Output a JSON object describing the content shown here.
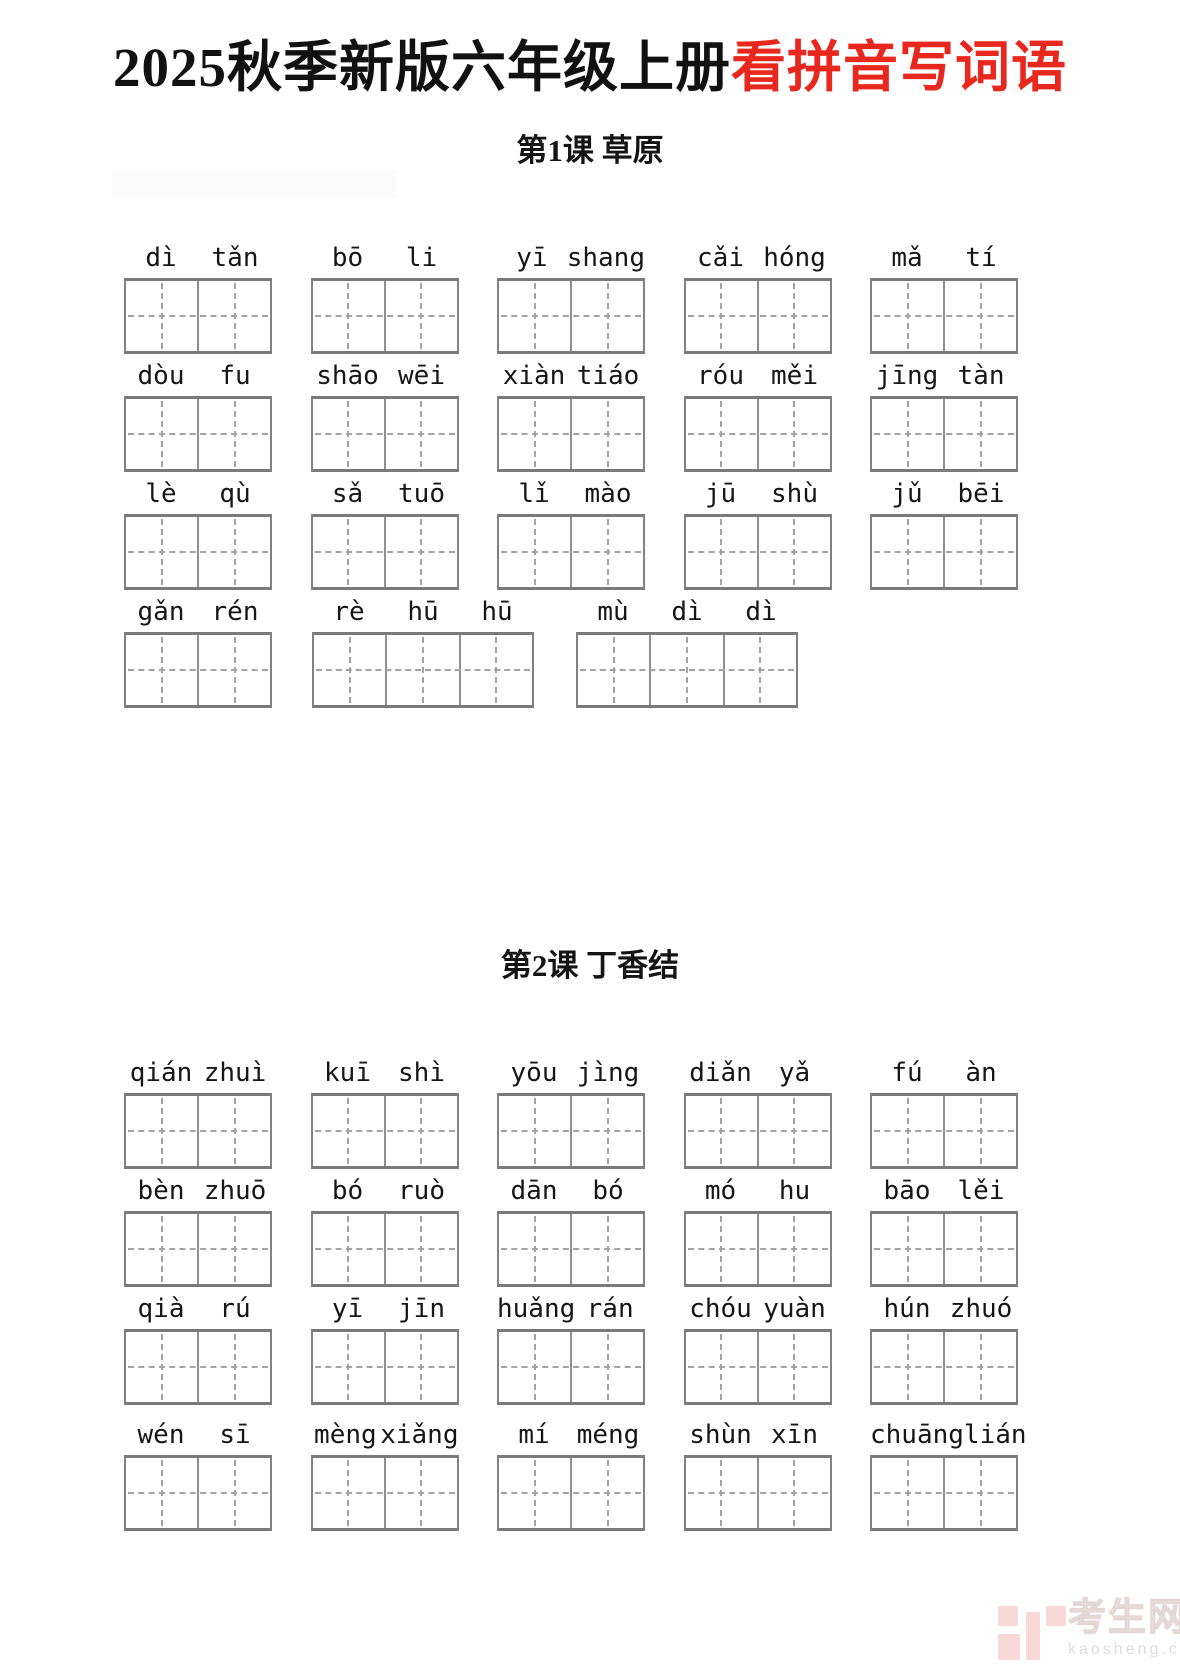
{
  "title": {
    "black_text": "2025秋季新版六年级上册",
    "red_text": "看拼音写词语",
    "black_color": "#111111",
    "red_color": "#e8281e"
  },
  "sections": [
    {
      "heading": "第1课 草原",
      "rows": [
        {
          "words": [
            {
              "syllables": [
                "dì",
                "tǎn"
              ]
            },
            {
              "syllables": [
                "bō",
                "li"
              ]
            },
            {
              "syllables": [
                "yī",
                "shang"
              ]
            },
            {
              "syllables": [
                "cǎi",
                "hóng"
              ]
            },
            {
              "syllables": [
                "mǎ",
                "tí"
              ]
            }
          ]
        },
        {
          "words": [
            {
              "syllables": [
                "dòu",
                "fu"
              ]
            },
            {
              "syllables": [
                "shāo",
                "wēi"
              ]
            },
            {
              "syllables": [
                "xiàn",
                "tiáo"
              ]
            },
            {
              "syllables": [
                "róu",
                "měi"
              ]
            },
            {
              "syllables": [
                "jīng",
                "tàn"
              ]
            }
          ]
        },
        {
          "words": [
            {
              "syllables": [
                "lè",
                "qù"
              ]
            },
            {
              "syllables": [
                "sǎ",
                "tuō"
              ]
            },
            {
              "syllables": [
                "lǐ",
                "mào"
              ]
            },
            {
              "syllables": [
                "jū",
                "shù"
              ]
            },
            {
              "syllables": [
                "jǔ",
                "bēi"
              ]
            }
          ]
        },
        {
          "words": [
            {
              "syllables": [
                "gǎn",
                "rén"
              ]
            },
            {
              "syllables": [
                "rè",
                "hū",
                "hū"
              ]
            },
            {
              "syllables": [
                "mù",
                "dì",
                "dì"
              ]
            }
          ]
        }
      ]
    },
    {
      "heading": "第2课 丁香结",
      "rows": [
        {
          "words": [
            {
              "syllables": [
                "qián",
                "zhuì"
              ]
            },
            {
              "syllables": [
                "kuī",
                "shì"
              ]
            },
            {
              "syllables": [
                "yōu",
                "jìng"
              ]
            },
            {
              "syllables": [
                "diǎn",
                "yǎ"
              ]
            },
            {
              "syllables": [
                "fú",
                "àn"
              ]
            }
          ]
        },
        {
          "words": [
            {
              "syllables": [
                "bèn",
                "zhuō"
              ]
            },
            {
              "syllables": [
                "bó",
                "ruò"
              ]
            },
            {
              "syllables": [
                "dān",
                "bó"
              ]
            },
            {
              "syllables": [
                "mó",
                "hu"
              ]
            },
            {
              "syllables": [
                "bāo",
                "lěi"
              ]
            }
          ]
        },
        {
          "words": [
            {
              "syllables": [
                "qià",
                "rú"
              ]
            },
            {
              "syllables": [
                "yī",
                "jīn"
              ]
            },
            {
              "syllables": [
                "huǎng",
                "rán"
              ]
            },
            {
              "syllables": [
                "chóu",
                "yuàn"
              ]
            },
            {
              "syllables": [
                "hún",
                "zhuó"
              ]
            }
          ]
        },
        {
          "words": [
            {
              "syllables": [
                "wén",
                "sī"
              ]
            },
            {
              "syllables": [
                "mèng",
                "xiǎng"
              ]
            },
            {
              "syllables": [
                "mí",
                "méng"
              ]
            },
            {
              "syllables": [
                "shùn",
                "xīn"
              ]
            },
            {
              "syllables": [
                "chuāng",
                "lián"
              ]
            }
          ]
        }
      ]
    }
  ],
  "watermark": {
    "site_name": "考生网",
    "site_url": "kaosheng.com",
    "logo_color": "#f9d9d7",
    "text_color": "#f0e4e2",
    "url_color": "#dcdcdc"
  }
}
